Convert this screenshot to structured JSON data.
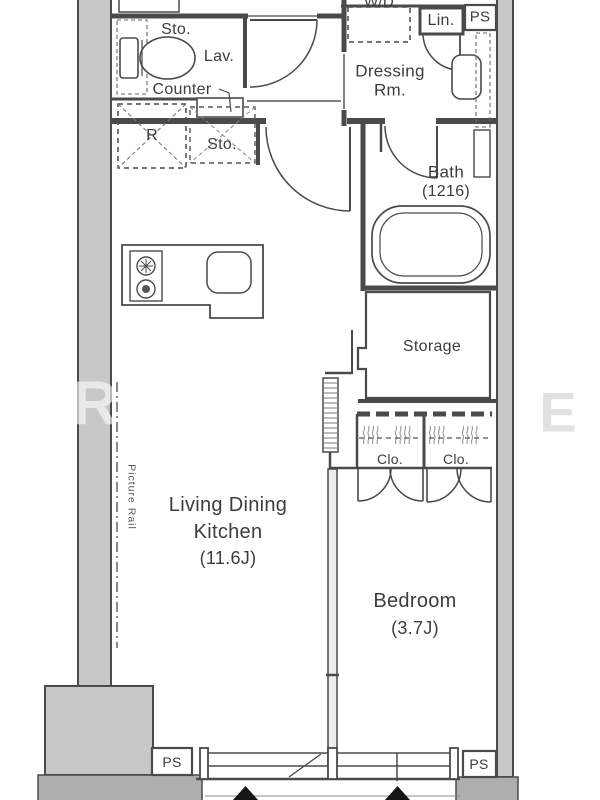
{
  "floorplan": {
    "labels": {
      "entry_storage": "Sto.",
      "lavatory": "Lav.",
      "counter": "Counter",
      "washer_dryer": "W/D",
      "linen": "Lin.",
      "dressing_line1": "Dressing",
      "dressing_line2": "Rm.",
      "bath_name": "Bath",
      "bath_size": "(1216)",
      "storage": "Storage",
      "refrigerator": "R",
      "kitchen_storage": "Sto.",
      "closet_left": "Clo.",
      "closet_right": "Clo.",
      "ldk_line1": "Living Dining",
      "ldk_line2": "Kitchen",
      "ldk_size": "(11.6J)",
      "bedroom_name": "Bedroom",
      "bedroom_size": "(3.7J)",
      "picture_rail": "Picture Rail",
      "ps_top_right": "PS",
      "ps_bottom_left": "PS",
      "ps_bottom_right": "PS"
    },
    "watermark": {
      "left_letter": "R",
      "right_letter": "E"
    },
    "colors": {
      "wall_fill": "#c8c8c8",
      "band_fill": "#aeaeae",
      "line": "#4a4a4a",
      "text": "#3d3d3d"
    }
  }
}
